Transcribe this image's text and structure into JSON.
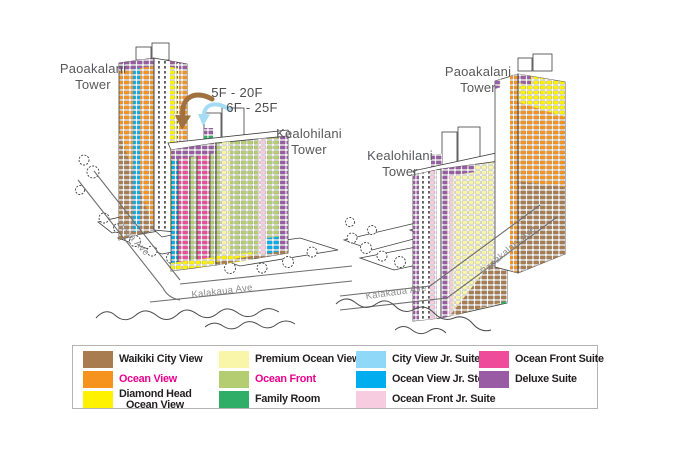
{
  "colors": {
    "waikiki_city_view": "#A97C50",
    "ocean_view": "#F6921E",
    "diamond_head_ocean_view": "#FFF200",
    "premium_ocean_view": "#F9F6A9",
    "ocean_front": "#B5CD71",
    "family_room": "#2FAE68",
    "city_view_jr_suite": "#8FD8F7",
    "ocean_view_jr_ste": "#00AEEF",
    "ocean_front_jr_suite": "#F8CCE0",
    "ocean_front_suite": "#EE4C9B",
    "deluxe_suite": "#9A5BA5",
    "highlight_text": "#EC008C",
    "label_gray": "#58595B",
    "street_gray": "#8C8C8C",
    "arrow_brown": "#A0703F",
    "arrow_blue": "#A5DCF5"
  },
  "illustrations": {
    "left": {
      "paoakalani_tower_label": {
        "line1": "Paoakalani",
        "line2": "Tower"
      },
      "kealohilani_tower_label": {
        "line1": "Kealohilani",
        "line2": "Tower"
      },
      "floor_range_annotation": {
        "line1": "5F - 20F",
        "line2": "6F - 25F"
      },
      "street_ohua": "Ohua Ave",
      "street_kalakaua": "Kalakaua Ave"
    },
    "right": {
      "paoakalani_tower_label": {
        "line1": "Paoakalani",
        "line2": "Tower"
      },
      "kealohilani_tower_label": {
        "line1": "Kealohilani",
        "line2": "Tower"
      },
      "street_kalakaua": "Kalakaua Ave",
      "street_paoakalani": "Paoakalani Ave"
    }
  },
  "legend": {
    "items": [
      {
        "label": "Waikiki City View",
        "color": "#A97C50",
        "highlight": false
      },
      {
        "label": "Ocean View",
        "color": "#F6921E",
        "highlight": true
      },
      {
        "label": "Diamond Head",
        "label2": "Ocean View",
        "color": "#FFF200",
        "highlight": false
      },
      {
        "label": "Premium Ocean View",
        "color": "#F9F6A9",
        "highlight": false
      },
      {
        "label": "Ocean Front",
        "color": "#B5CD71",
        "highlight": true
      },
      {
        "label": "Family Room",
        "color": "#2FAE68",
        "highlight": false
      },
      {
        "label": "City View Jr. Suite",
        "color": "#8FD8F7",
        "highlight": false
      },
      {
        "label": "Ocean View Jr. Ste",
        "color": "#00AEEF",
        "highlight": false
      },
      {
        "label": "Ocean Front Jr. Suite",
        "color": "#F8CCE0",
        "highlight": false
      },
      {
        "label": "Ocean Front Suite",
        "color": "#EE4C9B",
        "highlight": false
      },
      {
        "label": "Deluxe Suite",
        "color": "#9A5BA5",
        "highlight": false
      }
    ]
  }
}
